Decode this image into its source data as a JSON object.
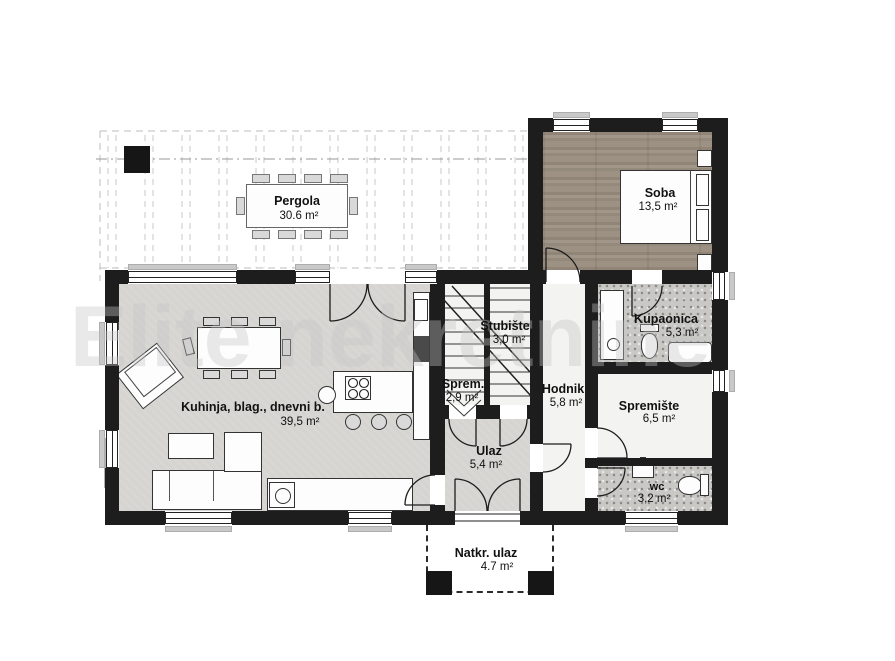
{
  "watermark": "Elite nekretnine",
  "rooms": {
    "pergola": {
      "name": "Pergola",
      "area": "30.6 m²"
    },
    "soba": {
      "name": "Soba",
      "area": "13,5 m²"
    },
    "stubiste": {
      "name": "Stubište",
      "area": "3,0 m²"
    },
    "sprem": {
      "name": "Sprem.",
      "area": "2,9 m²"
    },
    "hodnik": {
      "name": "Hodnik",
      "area": "5,8 m²"
    },
    "kupaonica": {
      "name": "Kupaonica",
      "area": "5,3 m²"
    },
    "spremiste": {
      "name": "Spremište",
      "area": "6,5 m²"
    },
    "wc": {
      "name": "wc",
      "area": "3,2 m²"
    },
    "kuhinja": {
      "name": "Kuhinja, blag., dnevni b.",
      "area": "39,5 m²"
    },
    "ulaz": {
      "name": "Ulaz",
      "area": "5,4 m²"
    },
    "natkr_ulaz": {
      "name": "Natkr. ulaz",
      "area": "4.7 m²"
    }
  },
  "colors": {
    "wall": "#1d1d1d",
    "living_floor": "#d8d7d3",
    "wood_floor": "#9c9183",
    "tile_floor": "#c9c8c5",
    "white_floor": "#f3f3f1",
    "pergola_lines": "#c9c9c9",
    "sill": "#c9c9c9",
    "label_text": "#111111"
  }
}
